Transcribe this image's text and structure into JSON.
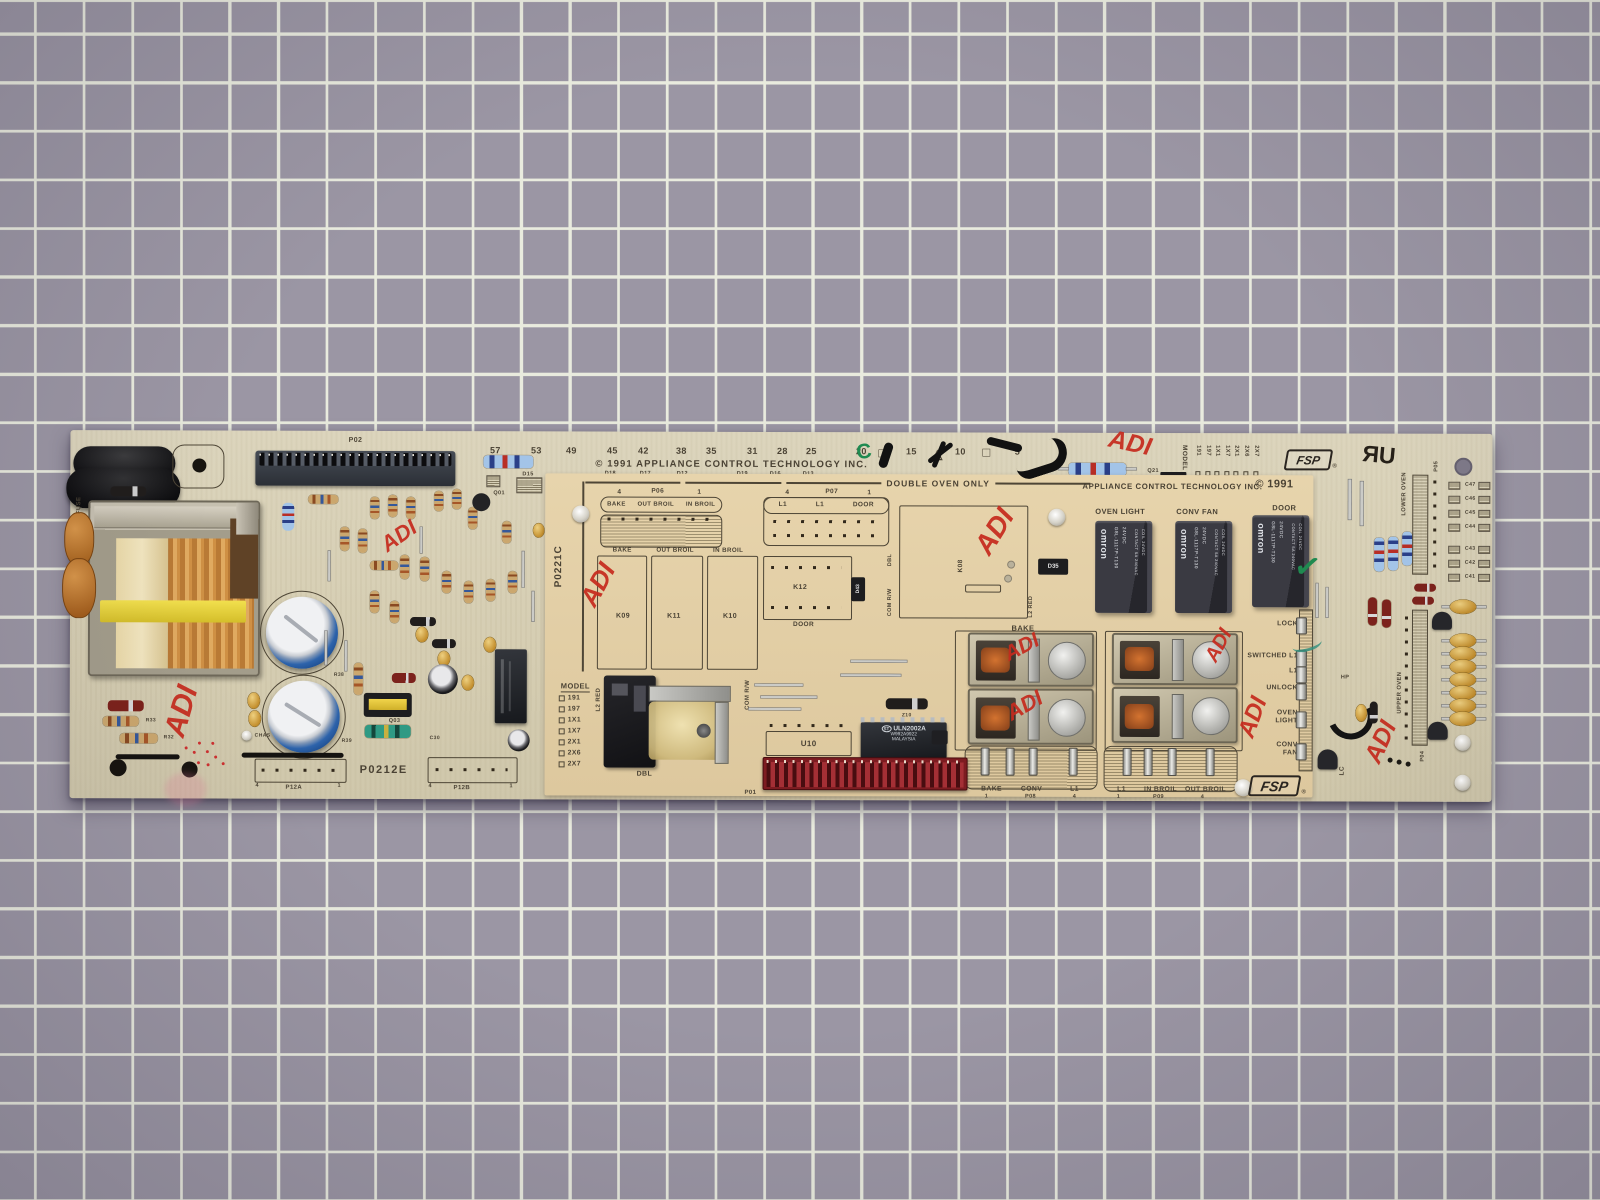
{
  "palette": {
    "mat": "#9b96a4",
    "grid": "#e9ebde",
    "board": "#d6ceb3",
    "daughterboard": "#e2cfa7",
    "marker_red": "#c62b1e",
    "silkscreen": "#4a4234"
  },
  "annotations": {
    "red_mark": "ADI",
    "green_letter": "C",
    "green_check": "✓"
  },
  "symbols": {
    "square": "□",
    "triangle": "△"
  },
  "main_board": {
    "part_number": "P0212E",
    "fuse_label": "FUSE",
    "copyright": "© 1991   APPLIANCE  CONTROL  TECHNOLOGY  INC.",
    "ruler": [
      "57",
      "53",
      "49",
      "45",
      "42",
      "38",
      "35",
      "31",
      "28",
      "25",
      "20",
      "15",
      "10",
      "5"
    ],
    "refs_row": [
      "D18",
      "D17",
      "D12",
      "D19",
      "D16",
      "D13"
    ],
    "p02": "P02",
    "p12a": "P12A",
    "p12b": "P12B",
    "pin_4": "4",
    "pin_1": "1",
    "chas": "CHAS",
    "r33": "R33",
    "r32": "R32",
    "r38": "R38",
    "r39": "R39",
    "q03": "Q03",
    "c30": "C30",
    "q01": "Q01",
    "d15": "D15",
    "q21": "Q21",
    "model_label": "MODEL",
    "model_options": [
      "191",
      "197",
      "1X1",
      "1X7",
      "2X1",
      "2X6",
      "2X7"
    ],
    "fsp": "FSP",
    "reg": "®",
    "ul": "ЯU",
    "lower_oven": "LOWER OVEN",
    "p05": "P05",
    "upper_oven": "UPPER OVEN",
    "p04": "P04",
    "cap_refs": [
      "C47",
      "C46",
      "C45",
      "C44",
      "C43",
      "C42",
      "C41"
    ],
    "hp": "HP",
    "lc": "LC"
  },
  "relay_board": {
    "part_number": "P0221C",
    "header": "DOUBLE OVEN ONLY",
    "company": "APPLIANCE  CONTROL  TECHNOLOGY  INC.",
    "copyright_year": "© 1991",
    "p06": {
      "pin_l": "4",
      "label": "P06",
      "pin_r": "1",
      "signals": [
        "BAKE",
        "OUT BROIL",
        "IN BROIL"
      ]
    },
    "p07": {
      "pin_l": "4",
      "label": "P07",
      "pin_r": "1",
      "signals": [
        "L1",
        "L1",
        "DOOR"
      ]
    },
    "relay_cols": {
      "refs": [
        "K09",
        "K11",
        "K10"
      ]
    },
    "k12": "K12",
    "k12_door": "DOOR",
    "d43": "D43",
    "k08": "K08",
    "d35": "D35",
    "dbl": "DBL",
    "com_rw": "COM R/W",
    "l2_red": "L2 RED",
    "model_label": "MODEL",
    "model_options": [
      "191",
      "197",
      "1X1",
      "1X7",
      "2X1",
      "2X6",
      "2X7"
    ],
    "dbl_relay": "DBL",
    "u10": "U10",
    "z10": "Z10",
    "ic": {
      "maker": "ST",
      "line1": "ULN2002A",
      "line2": "W992A9922",
      "line3": "MALAYSIA"
    },
    "p01": "P01",
    "bake_header": "BAKE",
    "p08": {
      "pin_l": "1",
      "label": "P08",
      "pin_r": "4",
      "signals": [
        "BAKE",
        "CONV",
        "L1"
      ]
    },
    "p09": {
      "pin_l": "1",
      "label": "P09",
      "pin_r": "4",
      "signals": [
        "L1",
        "IN BROIL",
        "OUT BROIL"
      ]
    },
    "omron": {
      "labels": [
        "OVEN LIGHT",
        "CONV FAN",
        "DOOR"
      ],
      "brand": "omron",
      "model": "G8L-1117P-T130",
      "volt": "24VDC",
      "contact": "CONTACT 5A 240VAC",
      "coil": "COIL 24VDC"
    },
    "side_labels": [
      "LOCK",
      "SWITCHED L1",
      "L1",
      "UNLOCK",
      "OVEN LIGHT",
      "CONV FAN"
    ],
    "fsp": "FSP",
    "reg": "®"
  }
}
